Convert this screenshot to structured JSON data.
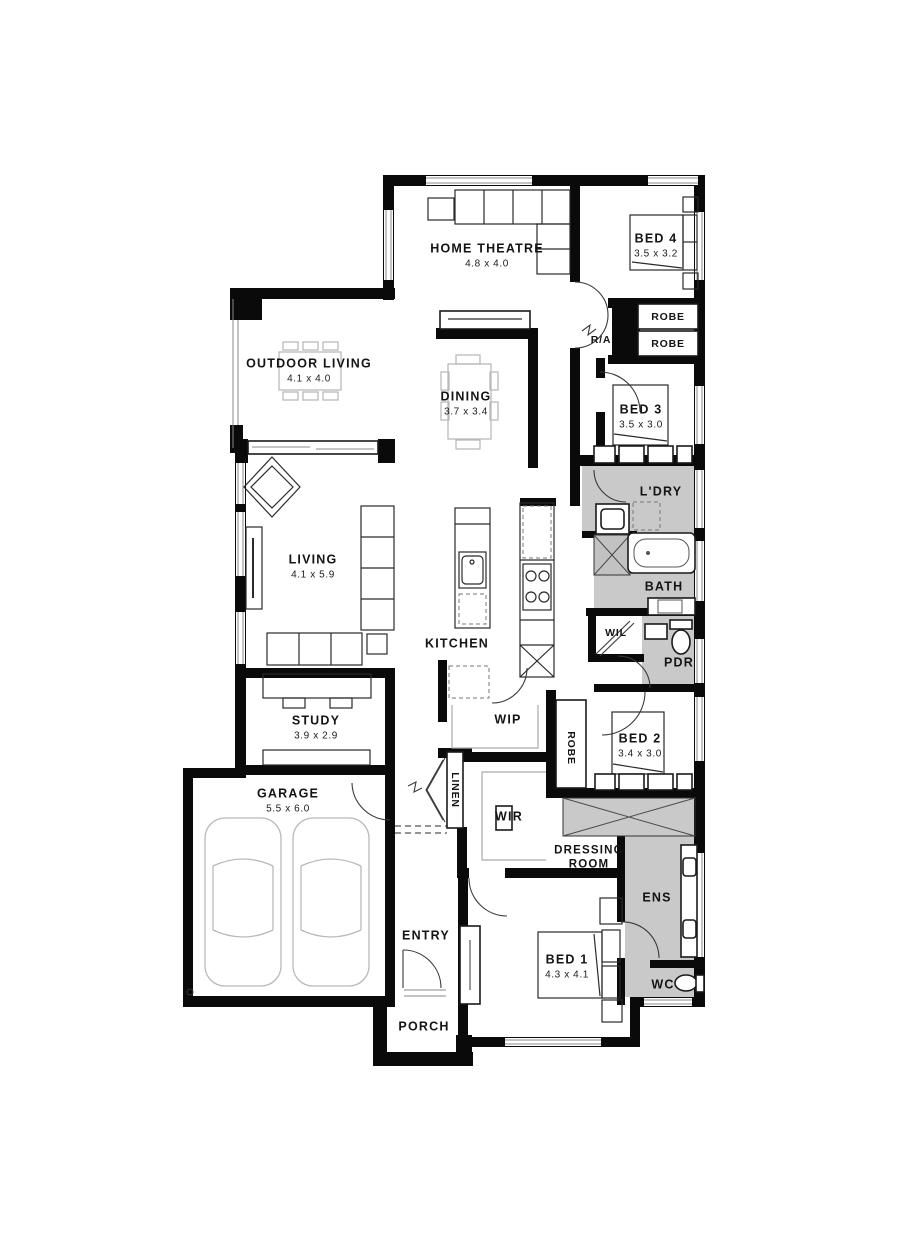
{
  "page": {
    "background": "#ffffff"
  },
  "colors": {
    "wall": "#0a0a0a",
    "wet_area": "#c9c9c9",
    "furniture_line": "#b9b9b9",
    "text": "#141414"
  },
  "rooms": {
    "home_theatre": {
      "name": "HOME THEATRE",
      "dims": "4.8 x 4.0"
    },
    "bed4": {
      "name": "BED 4",
      "dims": "3.5 x 3.2"
    },
    "outdoor_living": {
      "name": "OUTDOOR LIVING",
      "dims": "4.1 x 4.0"
    },
    "dining": {
      "name": "DINING",
      "dims": "3.7 x 3.4"
    },
    "bed3": {
      "name": "BED 3",
      "dims": "3.5 x 3.0"
    },
    "laundry": {
      "name": "L'DRY"
    },
    "bath": {
      "name": "BATH"
    },
    "wil": {
      "name": "WIL"
    },
    "pdr": {
      "name": "PDR"
    },
    "living": {
      "name": "LIVING",
      "dims": "4.1 x 5.9"
    },
    "kitchen": {
      "name": "KITCHEN"
    },
    "study": {
      "name": "STUDY",
      "dims": "3.9 x 2.9"
    },
    "wip": {
      "name": "WIP"
    },
    "bed2": {
      "name": "BED 2",
      "dims": "3.4 x 3.0"
    },
    "garage": {
      "name": "GARAGE",
      "dims": "5.5 x 6.0"
    },
    "wir": {
      "name": "WIR"
    },
    "dressing_room": {
      "line1": "DRESSING",
      "line2": "ROOM"
    },
    "ens": {
      "name": "ENS"
    },
    "bed1": {
      "name": "BED 1",
      "dims": "4.3 x 4.1"
    },
    "wc": {
      "name": "WC"
    },
    "entry": {
      "name": "ENTRY"
    },
    "porch": {
      "name": "PORCH"
    }
  },
  "fixtures": {
    "robe_bed4_top": "ROBE",
    "robe_bed4_bottom": "ROBE",
    "robe_bed2": "ROBE",
    "linen": "LINEN",
    "return_air": "R/A"
  }
}
